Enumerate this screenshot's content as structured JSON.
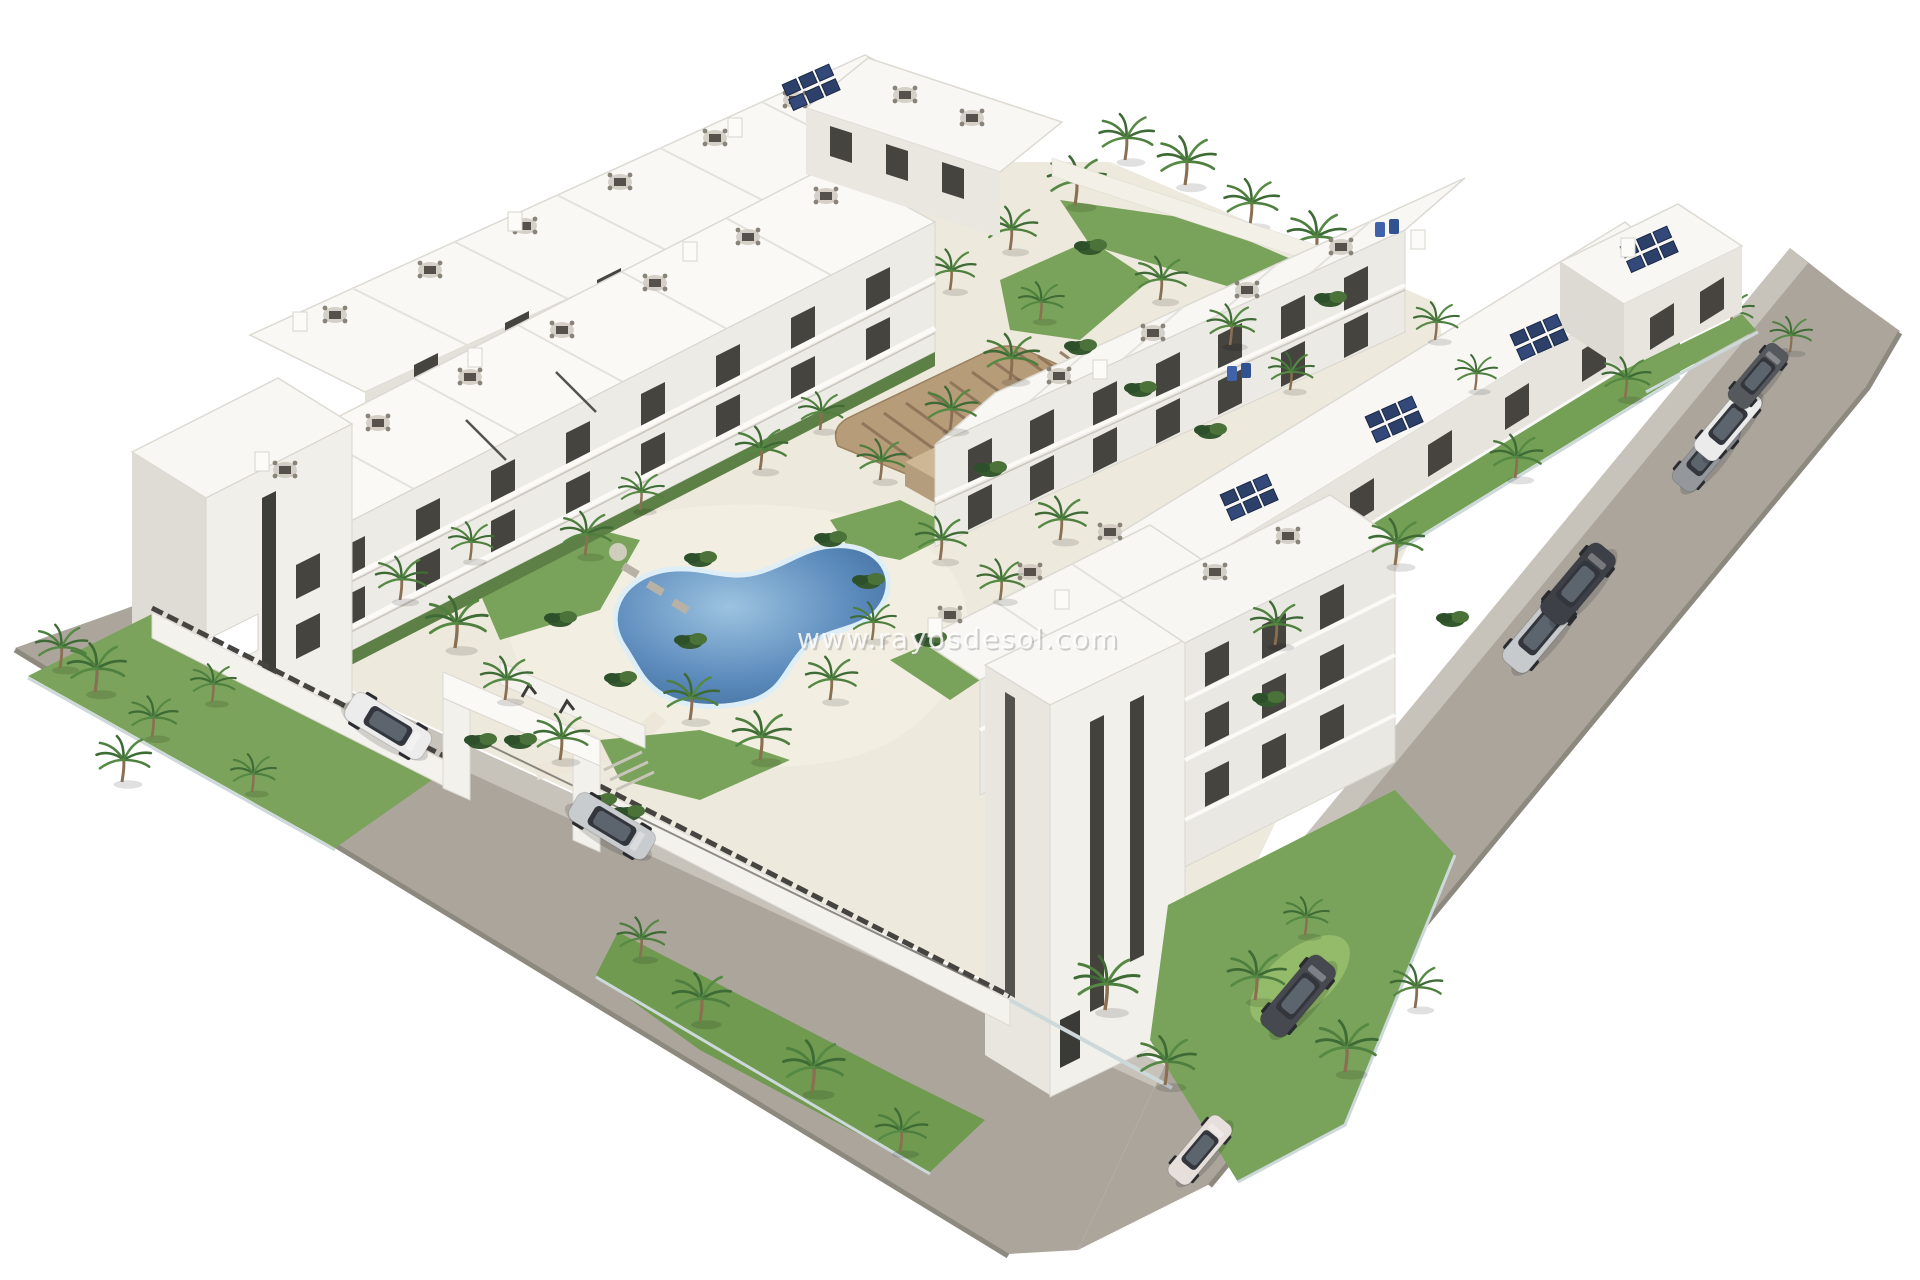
{
  "image": {
    "type": "architectural-3d-rendering",
    "subject": "Aerial 3D render of a white Mediterranean apartment complex with communal pools, palm-tree gardens, perimeter road and parked cars",
    "background_color": "#ffffff"
  },
  "watermark": {
    "text": "www.rayosdesol.com",
    "color": "#ffffff"
  },
  "palette": {
    "road": "#aba59c",
    "road_edge": "#8e897f",
    "sidewalk": "#c8c3ba",
    "deck": "#eee9dd",
    "deck_light": "#f2eee2",
    "building_white": "#f9f8f5",
    "facade_light": "#edebe5",
    "facade_shade": "#dedcd5",
    "window_dark": "#45443f",
    "hedge": "#5c8045",
    "lawn": "#79a35a",
    "lawn_bright": "#94bb6a",
    "foliage_dark": "#35582f",
    "foliage_mid": "#4e7f3e",
    "pool_deep": "#35618f",
    "pool_mid": "#4a7cb0",
    "pool_light": "#9cc3e0",
    "pool_rim": "#ddeef7",
    "pergola_wood": "#b79c79",
    "pergola_slat": "#8a7157",
    "solar_panel": "#2c4069",
    "fence_dark": "#454440",
    "glass_fence": "#cdd8da"
  },
  "scene": {
    "pools": [
      {
        "name": "kidney-pool",
        "shape": "freeform kidney",
        "cx": 750,
        "cy": 625
      },
      {
        "name": "lap-pool",
        "shape": "rectangular",
        "cx": 1223,
        "cy": 350
      }
    ],
    "buildings": [
      "west-back-row",
      "west-front-row",
      "west-end-tower",
      "north-block",
      "east-inner-row",
      "east-outer-row",
      "northeast-corner-block",
      "south-terrace-block",
      "foreground-tower-block"
    ],
    "entrance": {
      "name": "gate-portal",
      "x": 520,
      "y": 760,
      "marks": 2
    },
    "cars": [
      {
        "x": 388,
        "y": 726,
        "angle": 31,
        "color": "#ececec",
        "name": "white-suv"
      },
      {
        "x": 612,
        "y": 826,
        "angle": 31,
        "color": "#c9ccce",
        "name": "silver-sedan"
      },
      {
        "x": 1298,
        "y": 996,
        "angle": -50,
        "color": "#46494f",
        "name": "dark-grey-suv"
      },
      {
        "x": 1200,
        "y": 1150,
        "angle": -50,
        "color": "#e7dfdc",
        "name": "white-hatchback",
        "s": 0.85
      },
      {
        "x": 1540,
        "y": 632,
        "angle": -50,
        "color": "#c7cacc",
        "name": "silver-sedan"
      },
      {
        "x": 1578,
        "y": 584,
        "angle": -50,
        "color": "#3d4046",
        "name": "dark-sedan"
      },
      {
        "x": 1706,
        "y": 455,
        "angle": -50,
        "color": "#94989c",
        "name": "grey-suv",
        "s": 0.9
      },
      {
        "x": 1728,
        "y": 424,
        "angle": -50,
        "color": "#ebebeb",
        "name": "white-suv",
        "s": 0.9
      },
      {
        "x": 1758,
        "y": 376,
        "angle": -50,
        "color": "#55585d",
        "name": "dark-hatchback",
        "s": 0.8
      }
    ],
    "palms": [
      {
        "x": 95,
        "y": 692,
        "s": 0.9
      },
      {
        "x": 152,
        "y": 737,
        "s": 0.75
      },
      {
        "x": 212,
        "y": 702,
        "s": 0.7
      },
      {
        "x": 122,
        "y": 782,
        "s": 0.85
      },
      {
        "x": 252,
        "y": 792,
        "s": 0.7
      },
      {
        "x": 60,
        "y": 668,
        "s": 0.8
      },
      {
        "x": 400,
        "y": 600,
        "s": 0.8
      },
      {
        "x": 455,
        "y": 648,
        "s": 0.95
      },
      {
        "x": 505,
        "y": 700,
        "s": 0.8
      },
      {
        "x": 560,
        "y": 760,
        "s": 0.85
      },
      {
        "x": 470,
        "y": 560,
        "s": 0.7
      },
      {
        "x": 640,
        "y": 958,
        "s": 0.75
      },
      {
        "x": 700,
        "y": 1022,
        "s": 0.9
      },
      {
        "x": 812,
        "y": 1092,
        "s": 0.95
      },
      {
        "x": 900,
        "y": 1152,
        "s": 0.8
      },
      {
        "x": 1105,
        "y": 1010,
        "s": 1
      },
      {
        "x": 1165,
        "y": 1085,
        "s": 0.9
      },
      {
        "x": 1255,
        "y": 1000,
        "s": 0.9
      },
      {
        "x": 1345,
        "y": 1072,
        "s": 0.95
      },
      {
        "x": 1415,
        "y": 1008,
        "s": 0.8
      },
      {
        "x": 1305,
        "y": 935,
        "s": 0.7
      },
      {
        "x": 585,
        "y": 555,
        "s": 0.8
      },
      {
        "x": 640,
        "y": 510,
        "s": 0.7
      },
      {
        "x": 690,
        "y": 720,
        "s": 0.85
      },
      {
        "x": 760,
        "y": 760,
        "s": 0.9
      },
      {
        "x": 830,
        "y": 700,
        "s": 0.8
      },
      {
        "x": 872,
        "y": 640,
        "s": 0.7
      },
      {
        "x": 760,
        "y": 470,
        "s": 0.8
      },
      {
        "x": 820,
        "y": 430,
        "s": 0.7
      },
      {
        "x": 880,
        "y": 480,
        "s": 0.75
      },
      {
        "x": 950,
        "y": 430,
        "s": 0.8
      },
      {
        "x": 1010,
        "y": 380,
        "s": 0.85
      },
      {
        "x": 940,
        "y": 560,
        "s": 0.8
      },
      {
        "x": 1000,
        "y": 600,
        "s": 0.75
      },
      {
        "x": 1060,
        "y": 540,
        "s": 0.8
      },
      {
        "x": 1075,
        "y": 205,
        "s": 0.9
      },
      {
        "x": 1125,
        "y": 160,
        "s": 0.85
      },
      {
        "x": 1185,
        "y": 185,
        "s": 0.9
      },
      {
        "x": 1250,
        "y": 225,
        "s": 0.85
      },
      {
        "x": 1315,
        "y": 260,
        "s": 0.9
      },
      {
        "x": 1370,
        "y": 295,
        "s": 0.8
      },
      {
        "x": 1010,
        "y": 250,
        "s": 0.8
      },
      {
        "x": 950,
        "y": 290,
        "s": 0.75
      },
      {
        "x": 1040,
        "y": 320,
        "s": 0.7
      },
      {
        "x": 1160,
        "y": 300,
        "s": 0.8
      },
      {
        "x": 1230,
        "y": 345,
        "s": 0.75
      },
      {
        "x": 1290,
        "y": 390,
        "s": 0.7
      },
      {
        "x": 1275,
        "y": 645,
        "s": 0.8
      },
      {
        "x": 1395,
        "y": 565,
        "s": 0.85
      },
      {
        "x": 1515,
        "y": 478,
        "s": 0.8
      },
      {
        "x": 1625,
        "y": 398,
        "s": 0.75
      },
      {
        "x": 1730,
        "y": 330,
        "s": 0.7
      },
      {
        "x": 1790,
        "y": 352,
        "s": 0.65
      },
      {
        "x": 1435,
        "y": 340,
        "s": 0.7
      },
      {
        "x": 1475,
        "y": 390,
        "s": 0.65
      }
    ],
    "bushes": [
      {
        "x": 560,
        "y": 620
      },
      {
        "x": 620,
        "y": 680
      },
      {
        "x": 700,
        "y": 560
      },
      {
        "x": 868,
        "y": 582
      },
      {
        "x": 930,
        "y": 640
      },
      {
        "x": 1080,
        "y": 348
      },
      {
        "x": 1140,
        "y": 390
      },
      {
        "x": 990,
        "y": 470
      },
      {
        "x": 830,
        "y": 540
      },
      {
        "x": 690,
        "y": 642
      },
      {
        "x": 1210,
        "y": 432
      },
      {
        "x": 520,
        "y": 742
      },
      {
        "x": 1268,
        "y": 700
      },
      {
        "x": 1452,
        "y": 620
      },
      {
        "x": 480,
        "y": 742
      },
      {
        "x": 600,
        "y": 802
      },
      {
        "x": 628,
        "y": 814
      },
      {
        "x": 1090,
        "y": 248
      },
      {
        "x": 1330,
        "y": 300
      }
    ],
    "roof_furniture": [
      {
        "x": 335,
        "y": 315
      },
      {
        "x": 430,
        "y": 270
      },
      {
        "x": 525,
        "y": 226
      },
      {
        "x": 620,
        "y": 182
      },
      {
        "x": 715,
        "y": 138
      },
      {
        "x": 795,
        "y": 100
      },
      {
        "x": 285,
        "y": 470
      },
      {
        "x": 378,
        "y": 423
      },
      {
        "x": 470,
        "y": 377
      },
      {
        "x": 562,
        "y": 330
      },
      {
        "x": 655,
        "y": 283
      },
      {
        "x": 748,
        "y": 237
      },
      {
        "x": 826,
        "y": 196
      },
      {
        "x": 905,
        "y": 95
      },
      {
        "x": 972,
        "y": 118
      },
      {
        "x": 1059,
        "y": 376
      },
      {
        "x": 1153,
        "y": 333
      },
      {
        "x": 1247,
        "y": 290
      },
      {
        "x": 1341,
        "y": 247
      },
      {
        "x": 950,
        "y": 615
      },
      {
        "x": 1030,
        "y": 572
      },
      {
        "x": 1110,
        "y": 532
      },
      {
        "x": 1215,
        "y": 572
      },
      {
        "x": 1288,
        "y": 536
      }
    ],
    "solar_panels": [
      {
        "x": 1250,
        "y": 498
      },
      {
        "x": 1395,
        "y": 420
      },
      {
        "x": 1540,
        "y": 338
      },
      {
        "x": 1650,
        "y": 250
      },
      {
        "x": 812,
        "y": 88
      }
    ],
    "blue_loungers": [
      {
        "x": 1388,
        "y": 228
      },
      {
        "x": 1240,
        "y": 372
      }
    ],
    "roof_chimneys": [
      {
        "x": 300,
        "y": 322
      },
      {
        "x": 515,
        "y": 222
      },
      {
        "x": 735,
        "y": 128
      },
      {
        "x": 262,
        "y": 462
      },
      {
        "x": 475,
        "y": 358
      },
      {
        "x": 690,
        "y": 252
      },
      {
        "x": 1418,
        "y": 240
      },
      {
        "x": 1100,
        "y": 370
      },
      {
        "x": 1628,
        "y": 248
      },
      {
        "x": 1062,
        "y": 600
      },
      {
        "x": 935,
        "y": 628
      }
    ]
  }
}
